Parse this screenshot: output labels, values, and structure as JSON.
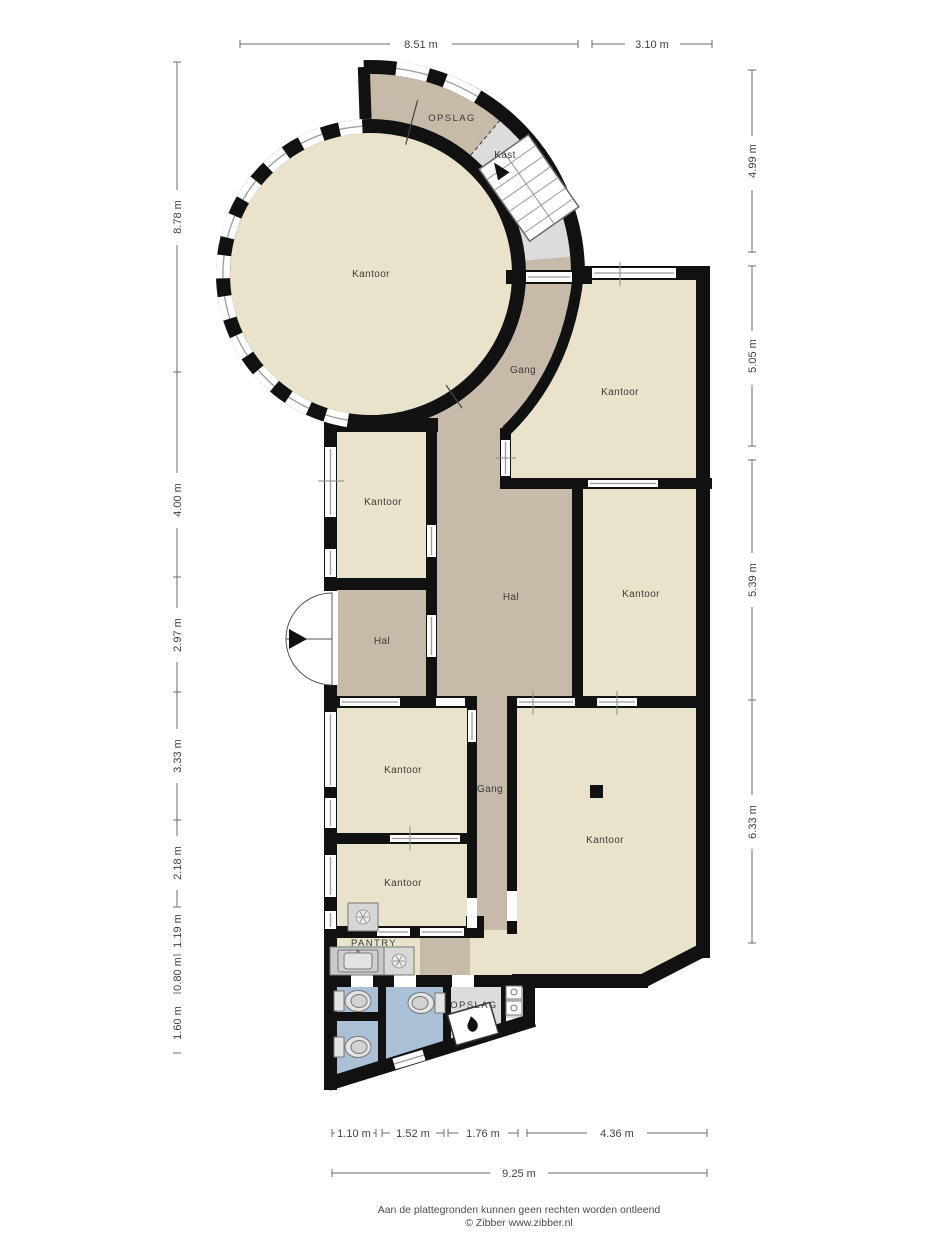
{
  "rooms": {
    "kantoor_circle": "Kantoor",
    "opslag_top": "OPSLAG",
    "kast": "Kast",
    "gang_top": "Gang",
    "kantoor_top_right": "Kantoor",
    "kantoor_left": "Kantoor",
    "hal_center": "Hal",
    "kantoor_mid_right": "Kantoor",
    "hal_entrance": "Hal",
    "kantoor_lower_left_1": "Kantoor",
    "gang_lower": "Gang",
    "kantoor_big": "Kantoor",
    "kantoor_lower_left_2": "Kantoor",
    "pantry": "PANTRY",
    "opslag_bottom": "OPSLAG"
  },
  "dimensions": {
    "top": [
      "8.51 m",
      "3.10 m"
    ],
    "left": [
      "8.78 m",
      "4.00 m",
      "2.97 m",
      "3.33 m",
      "2.18 m",
      "1.19 m",
      "0.80 m",
      "1.60 m"
    ],
    "right": [
      "4.99 m",
      "5.05 m",
      "5.39 m",
      "6.33 m"
    ],
    "bottom": [
      "1.10 m",
      "1.52 m",
      "1.76 m",
      "4.36 m"
    ],
    "bottom_total": "9.25 m"
  },
  "footer": {
    "disclaimer": "Aan de plattegronden kunnen geen rechten worden ontleend",
    "credit": "© Zibber www.zibber.nl"
  },
  "colors": {
    "wall": "#111111",
    "room_beige": "#eae3cb",
    "corridor_taupe": "#c8baa9",
    "closet_gray": "#dcdcda",
    "wet_blue": "#a9c0d6",
    "counter_gray": "#c9c9c9",
    "stair_white": "#ffffff"
  }
}
